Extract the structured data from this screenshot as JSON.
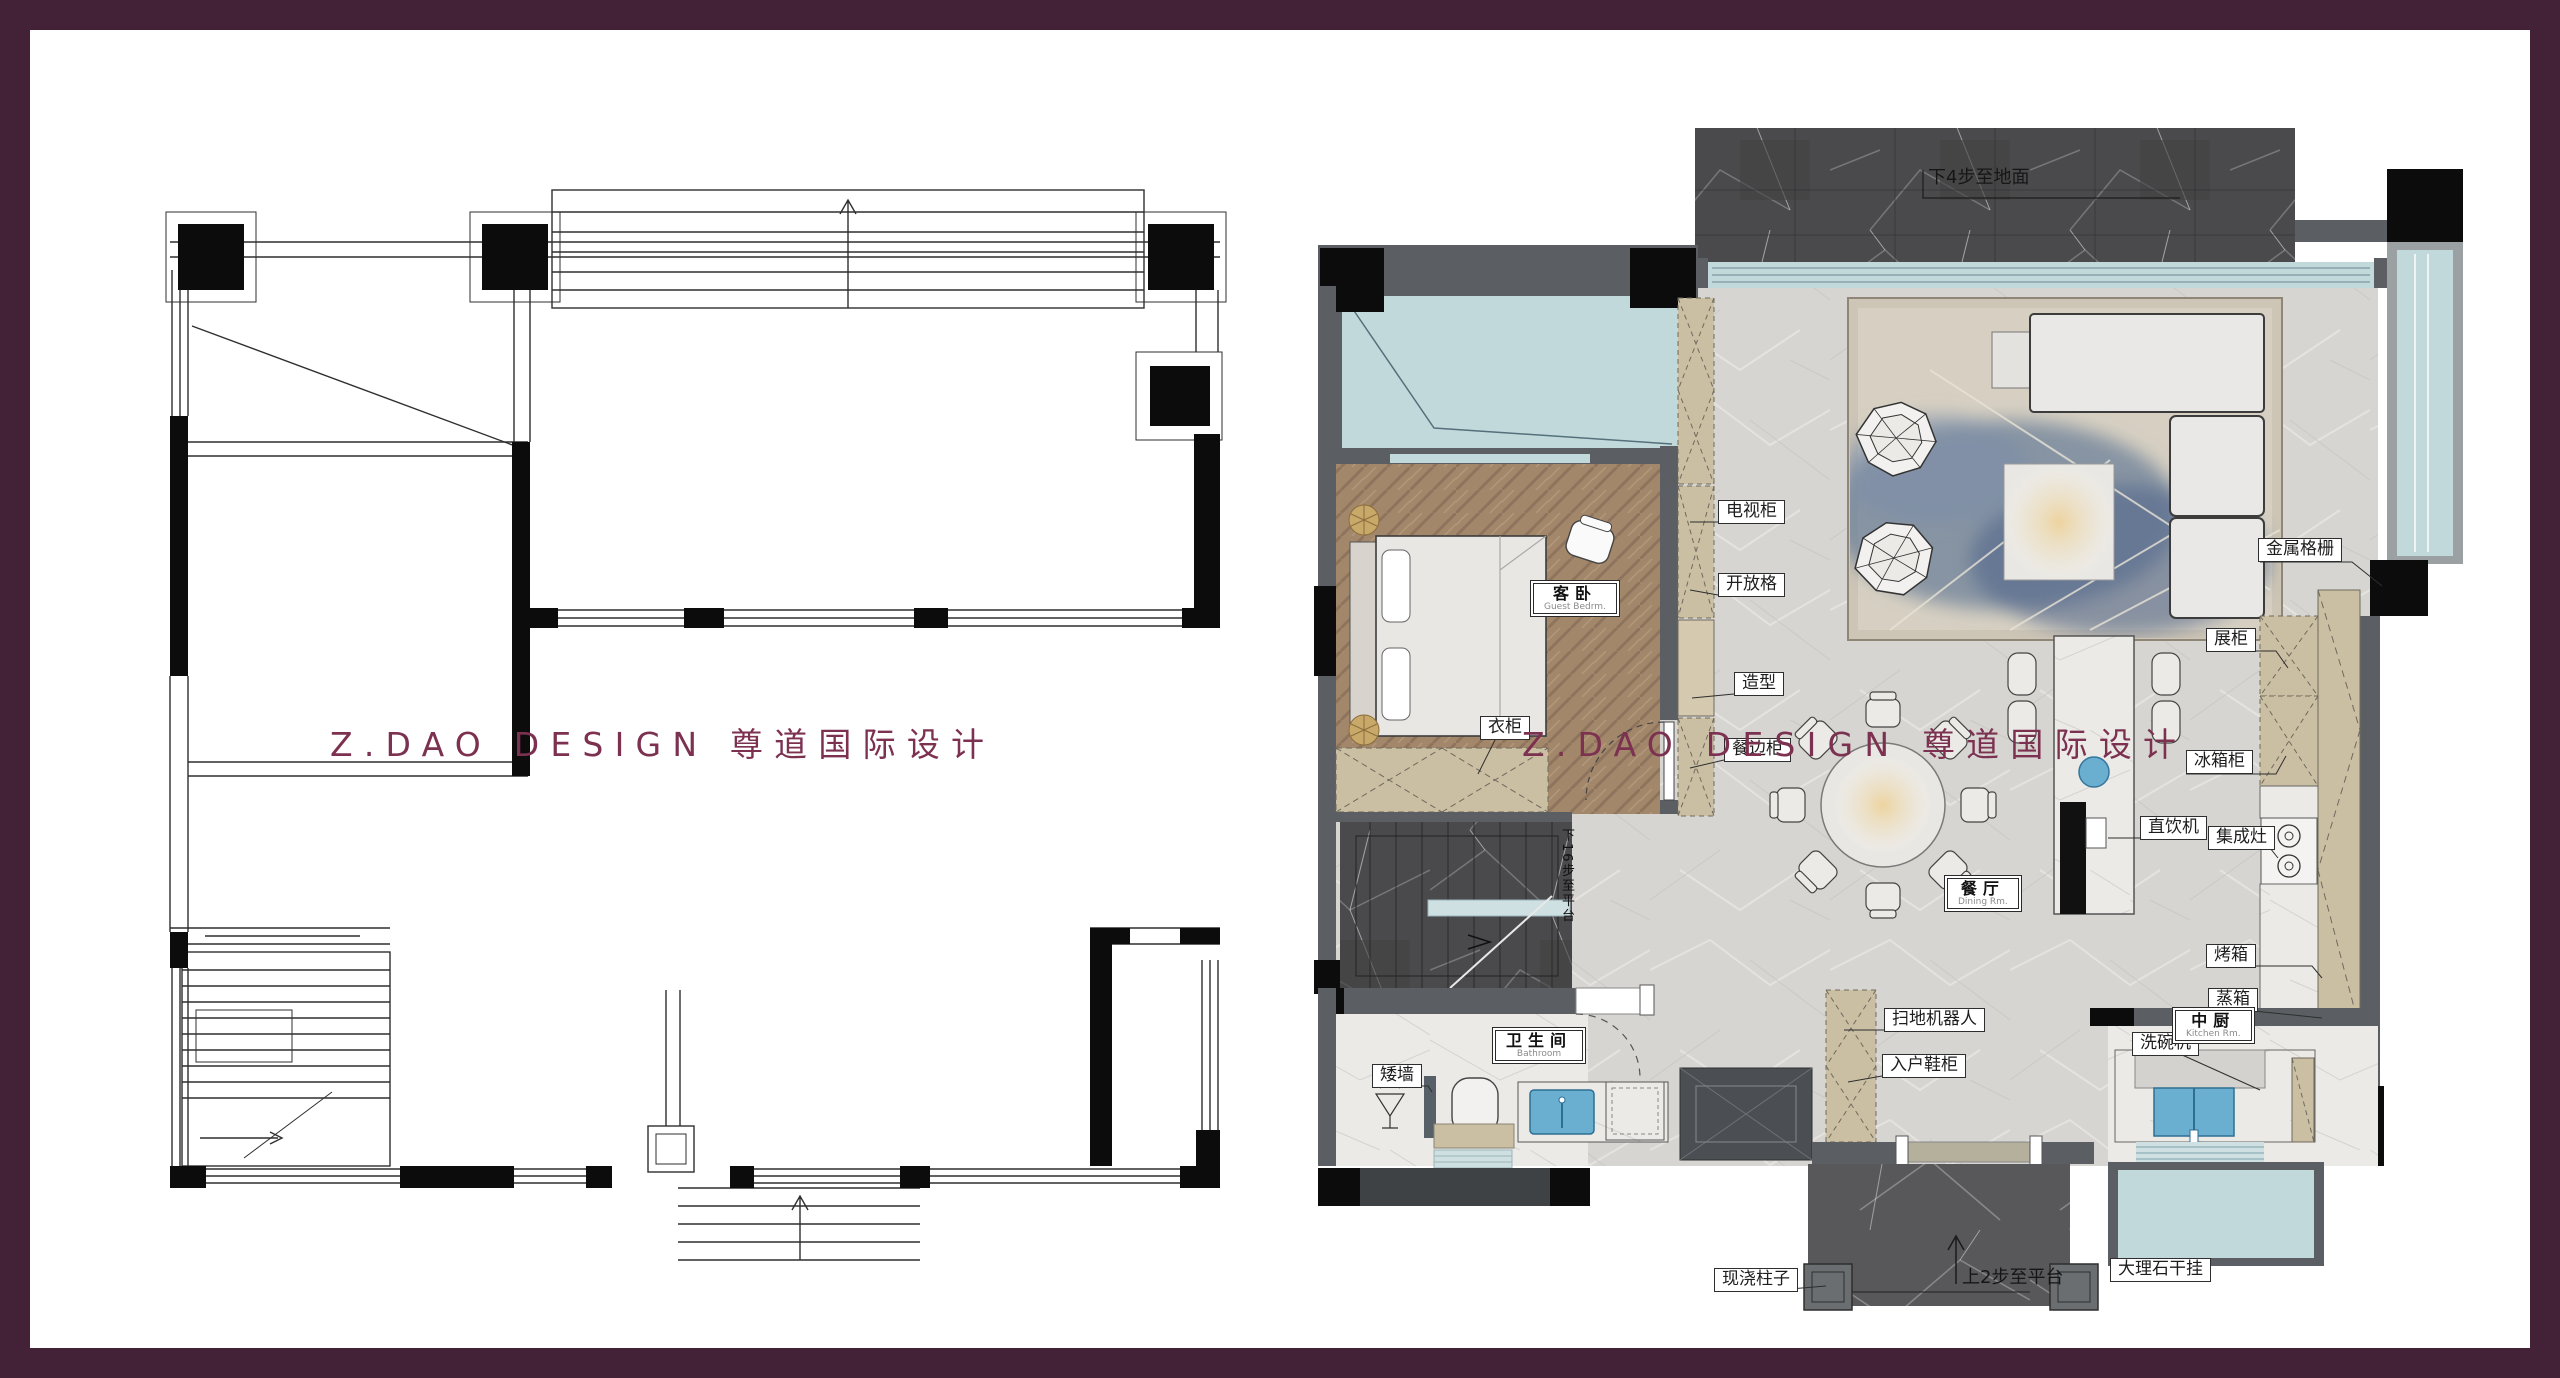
{
  "frame": {
    "color": "#432136"
  },
  "watermark": {
    "text": "Z.DAO DESIGN 尊道国际设计",
    "color": "#7c3150"
  },
  "right_plan": {
    "room_labels": [
      {
        "zh": "客卧",
        "en": "Guest Bedrm.",
        "x": 1500,
        "y": 550
      },
      {
        "zh": "餐厅",
        "en": "Dining Rm.",
        "x": 1914,
        "y": 845
      },
      {
        "zh": "中厨",
        "en": "Kitchen Rm.",
        "x": 2142,
        "y": 977
      },
      {
        "zh": "卫生间",
        "en": "Bathroom",
        "x": 1462,
        "y": 997
      }
    ],
    "tags": [
      {
        "text": "电视柜",
        "x": 1688,
        "y": 470,
        "variant": "box"
      },
      {
        "text": "开放格",
        "x": 1688,
        "y": 543,
        "variant": "box"
      },
      {
        "text": "造型",
        "x": 1704,
        "y": 642,
        "variant": "box"
      },
      {
        "text": "餐边柜",
        "x": 1694,
        "y": 708,
        "variant": "box"
      },
      {
        "text": "衣柜",
        "x": 1450,
        "y": 686,
        "variant": "box"
      },
      {
        "text": "金属格栅",
        "x": 2228,
        "y": 508,
        "variant": "box"
      },
      {
        "text": "展柜",
        "x": 2176,
        "y": 598,
        "variant": "box"
      },
      {
        "text": "冰箱柜",
        "x": 2156,
        "y": 720,
        "variant": "box"
      },
      {
        "text": "直饮机",
        "x": 2110,
        "y": 786,
        "variant": "box"
      },
      {
        "text": "集成灶",
        "x": 2178,
        "y": 796,
        "variant": "box"
      },
      {
        "text": "烤箱",
        "x": 2176,
        "y": 914,
        "variant": "box"
      },
      {
        "text": "蒸箱",
        "x": 2178,
        "y": 958,
        "variant": "box"
      },
      {
        "text": "洗碗机",
        "x": 2102,
        "y": 1002,
        "variant": "box"
      },
      {
        "text": "扫地机器人",
        "x": 1854,
        "y": 978,
        "variant": "box"
      },
      {
        "text": "入户鞋柜",
        "x": 1852,
        "y": 1024,
        "variant": "box"
      },
      {
        "text": "矮墙",
        "x": 1342,
        "y": 1034,
        "variant": "box"
      },
      {
        "text": "现浇柱子",
        "x": 1684,
        "y": 1238,
        "variant": "box"
      },
      {
        "text": "大理石干挂",
        "x": 2080,
        "y": 1228,
        "variant": "box"
      },
      {
        "text": "下4步至地面",
        "x": 1898,
        "y": 138,
        "variant": "plain"
      },
      {
        "text": "上2步至平台",
        "x": 1932,
        "y": 1238,
        "variant": "plain"
      },
      {
        "text": "下16步至平台",
        "x": 1528,
        "y": 798,
        "variant": "vertical"
      }
    ]
  },
  "colors": {
    "glass": "#c2d9dc",
    "wood": "#a3876a",
    "cabinet_tan": "#cbbfa3",
    "dark_marble": "#4a4a4c",
    "light_floor": "#d7d5d2",
    "sink_blue": "#6aaed0",
    "wall_gray": "#5b5f63"
  }
}
